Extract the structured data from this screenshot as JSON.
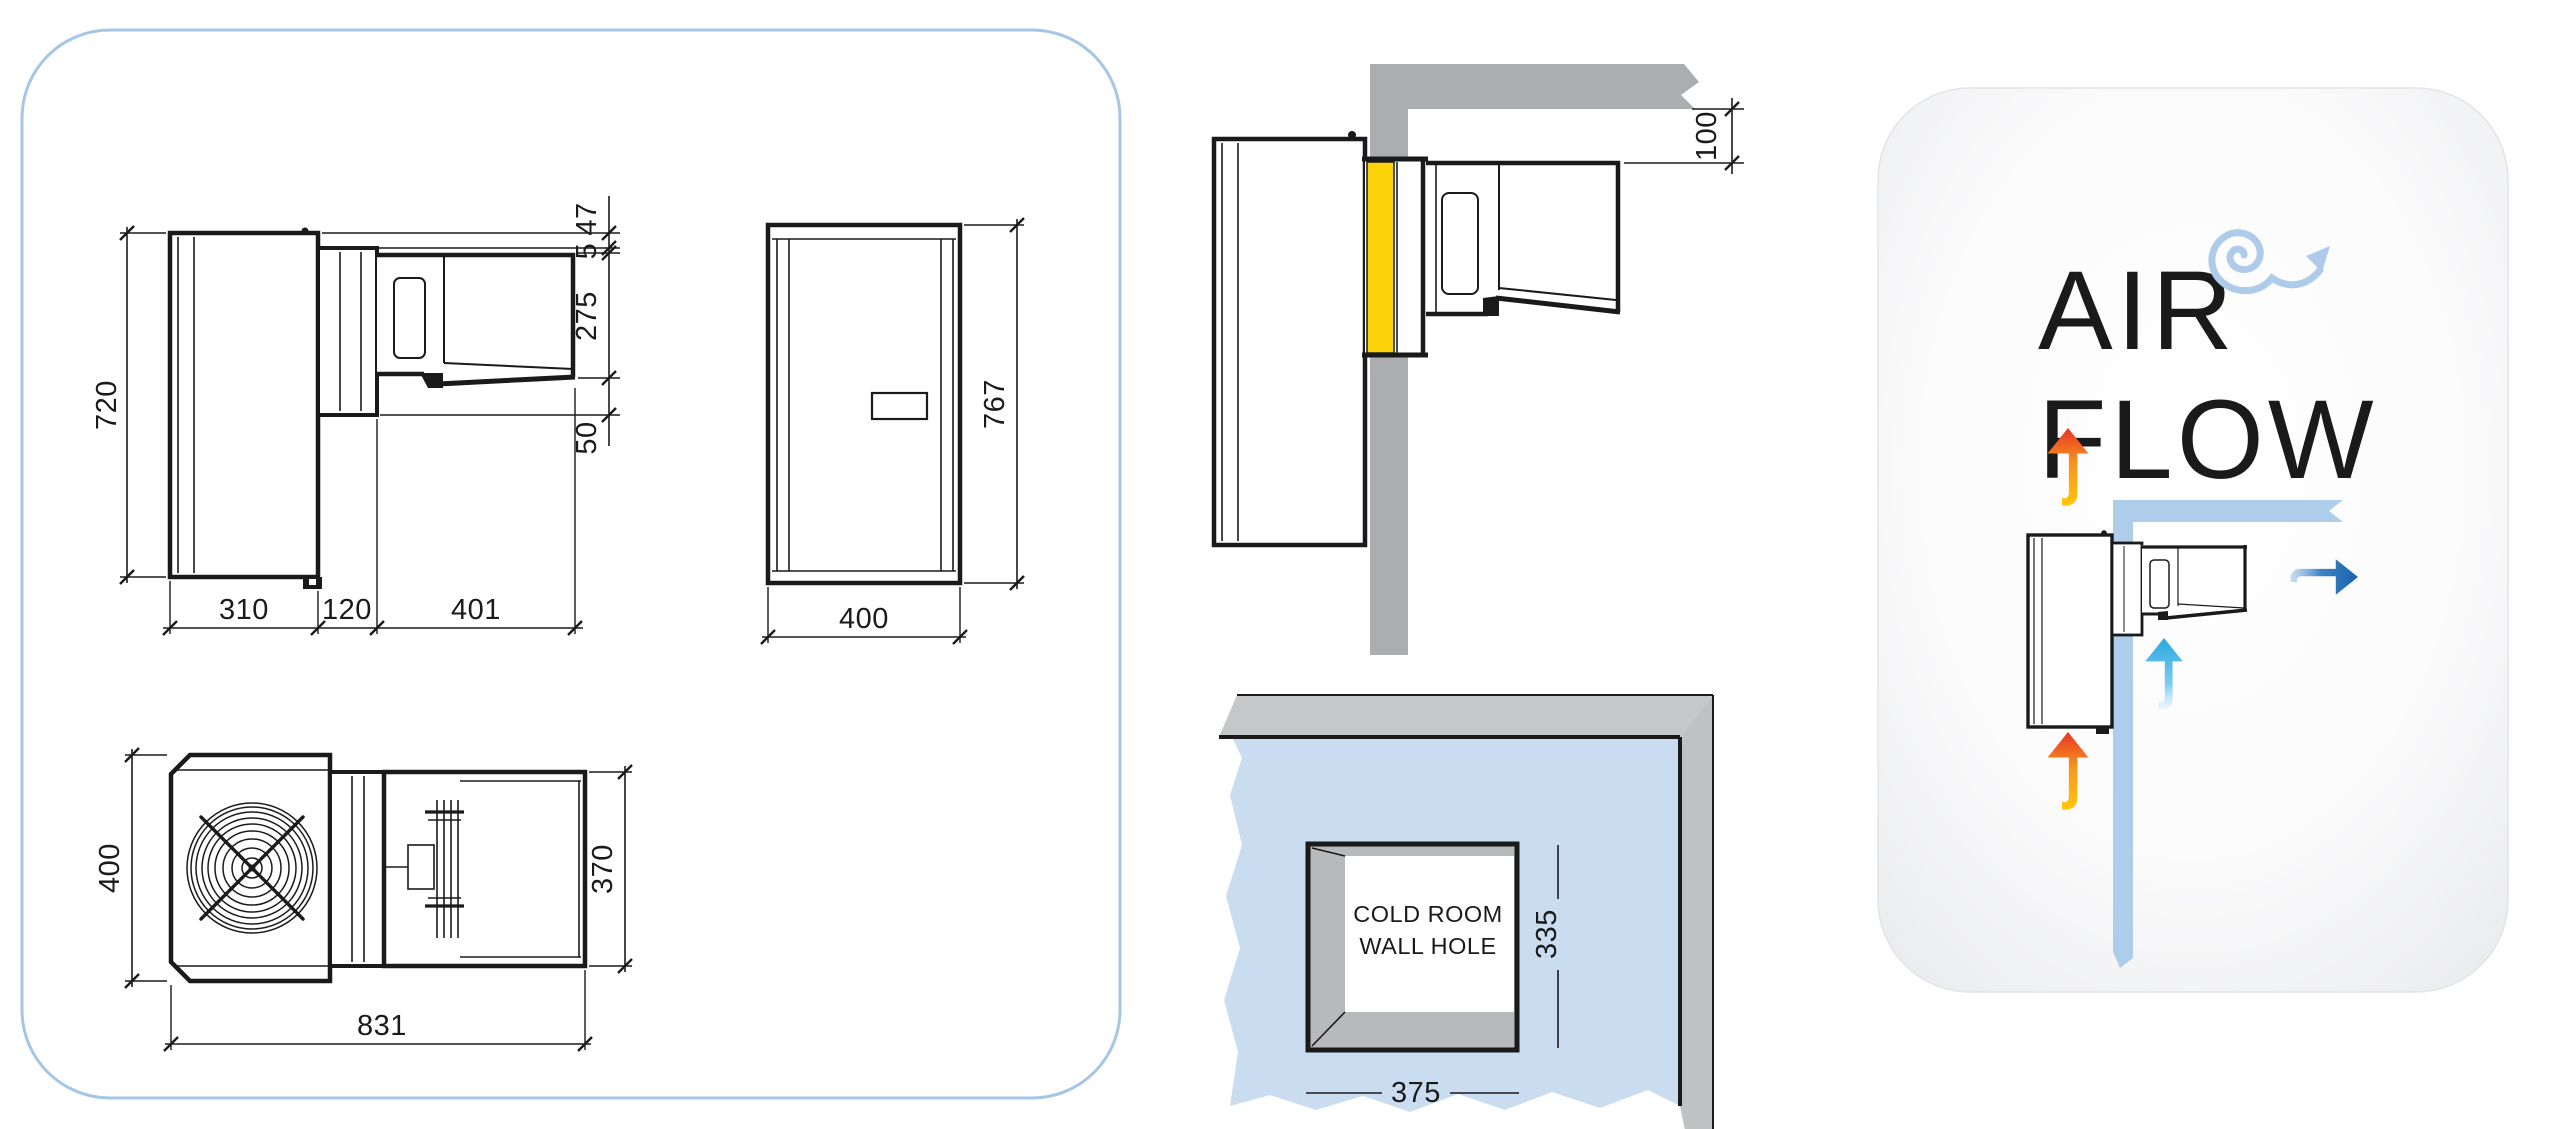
{
  "canvas": {
    "width": 2557,
    "height": 1129,
    "background": "#FFFFFF"
  },
  "colors": {
    "line": "#1A1A1A",
    "panel_border": "#A5C6E5",
    "wall_gray": "#ABADB0",
    "wall_top_gray": "#C6C7C9",
    "wall_side_gray": "#C0C1C3",
    "hole_inner_gray": "#B7B9BB",
    "wall_blue": "#CADDF0",
    "gasket_yellow": "#FCD20A",
    "strip_blue": "#AECDEA",
    "title_gray": "#8E9093",
    "warm_arrow_top": "#E8402A",
    "warm_arrow_bottom": "#FFC907",
    "cold_arrow": "#29A8E0",
    "exhaust_arrow": "#1B5FA8"
  },
  "dimension_views": {
    "side_view": {
      "dims": {
        "total_height": "720",
        "top_offset": "47",
        "panel_gap": "5",
        "condenser_height": "275",
        "bottom_offset": "50",
        "evaporator_depth": "310",
        "wall_section": "120",
        "condenser_depth": "401"
      }
    },
    "front_view": {
      "dims": {
        "height": "767",
        "width": "400"
      }
    },
    "plan_view": {
      "dims": {
        "width": "400",
        "condenser_width": "370",
        "total_depth": "831"
      }
    }
  },
  "installation": {
    "wall_section": {
      "dims": {
        "ceiling_clearance": "100"
      }
    },
    "wall_hole": {
      "label_line1": "COLD ROOM",
      "label_line2": "WALL HOLE",
      "dims": {
        "width": "375",
        "height": "335"
      }
    }
  },
  "airflow_panel": {
    "title_line1": "AIR",
    "title_line2": "FLOW"
  }
}
